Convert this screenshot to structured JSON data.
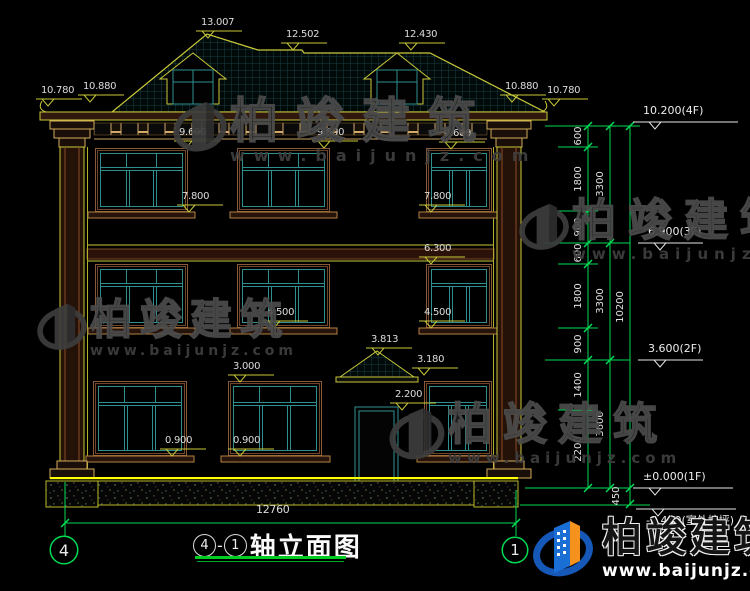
{
  "watermark": {
    "brand": "柏竣建筑",
    "url": "www.baijunjz.com"
  },
  "footer_logo": {
    "brand": "柏竣建筑",
    "url": "www.baijunjz.com"
  },
  "title_block": {
    "axis_from": "4",
    "separator": "-",
    "axis_to": "1",
    "title": "轴立面图"
  },
  "axis_bubbles": {
    "left": "4",
    "right": "1"
  },
  "dimensions": {
    "overall_width": "12760",
    "markers": [
      {
        "label": "13.007",
        "x": 208,
        "y": 31
      },
      {
        "label": "12.502",
        "x": 293,
        "y": 43
      },
      {
        "label": "12.430",
        "x": 411,
        "y": 43
      },
      {
        "label": "10.780",
        "x": 48,
        "y": 99
      },
      {
        "label": "10.880",
        "x": 90,
        "y": 95
      },
      {
        "label": "10.880",
        "x": 512,
        "y": 95
      },
      {
        "label": "10.780",
        "x": 554,
        "y": 99
      },
      {
        "label": "9.600",
        "x": 186,
        "y": 141
      },
      {
        "label": "9.600",
        "x": 324,
        "y": 141
      },
      {
        "label": "9.600",
        "x": 451,
        "y": 142
      },
      {
        "label": "7.800",
        "x": 189,
        "y": 205
      },
      {
        "label": "7.800",
        "x": 431,
        "y": 205
      },
      {
        "label": "6.300",
        "x": 431,
        "y": 257
      },
      {
        "label": "4.500",
        "x": 274,
        "y": 321
      },
      {
        "label": "4.500",
        "x": 431,
        "y": 321
      },
      {
        "label": "3.813",
        "x": 378,
        "y": 348
      },
      {
        "label": "3.180",
        "x": 424,
        "y": 368
      },
      {
        "label": "3.000",
        "x": 240,
        "y": 375
      },
      {
        "label": "2.200",
        "x": 402,
        "y": 403
      },
      {
        "label": "0.900",
        "x": 172,
        "y": 449
      },
      {
        "label": "0.900",
        "x": 240,
        "y": 449
      }
    ],
    "levels": [
      {
        "label": "10.200(4F)",
        "x": 655,
        "y": 122,
        "len": 105,
        "below": false
      },
      {
        "label": "6.900(3F)",
        "x": 660,
        "y": 243,
        "len": 65,
        "below": false
      },
      {
        "label": "3.600(2F)",
        "x": 660,
        "y": 360,
        "len": 65,
        "below": false
      },
      {
        "label": "±0.000(1F)",
        "x": 655,
        "y": 488,
        "len": 100,
        "below": false
      },
      {
        "label": "-0.450(室外地坪)",
        "x": 658,
        "y": 509,
        "len": 100,
        "below": true
      }
    ],
    "chain": [
      {
        "label": "600",
        "x": 579,
        "y": 136
      },
      {
        "label": "1800",
        "x": 579,
        "y": 179
      },
      {
        "label": "900",
        "x": 579,
        "y": 227
      },
      {
        "label": "600",
        "x": 579,
        "y": 253
      },
      {
        "label": "1800",
        "x": 579,
        "y": 296
      },
      {
        "label": "900",
        "x": 579,
        "y": 344
      },
      {
        "label": "1400",
        "x": 579,
        "y": 385
      },
      {
        "label": "2200",
        "x": 579,
        "y": 449
      },
      {
        "label": "3300",
        "x": 601,
        "y": 184
      },
      {
        "label": "3300",
        "x": 601,
        "y": 301
      },
      {
        "label": "3600",
        "x": 601,
        "y": 424
      },
      {
        "label": "10200",
        "x": 621,
        "y": 307
      },
      {
        "label": "450",
        "x": 617,
        "y": 496
      }
    ]
  },
  "colors": {
    "cad_yellow": "#c9c93a",
    "dim_green": "#00dd55",
    "window_teal": "#2f8f8f",
    "frame_brown": "#8a5a38",
    "ground_yellow": "#ffff00",
    "logo_blue": "#1a6fd4",
    "logo_orange": "#f5921e"
  }
}
